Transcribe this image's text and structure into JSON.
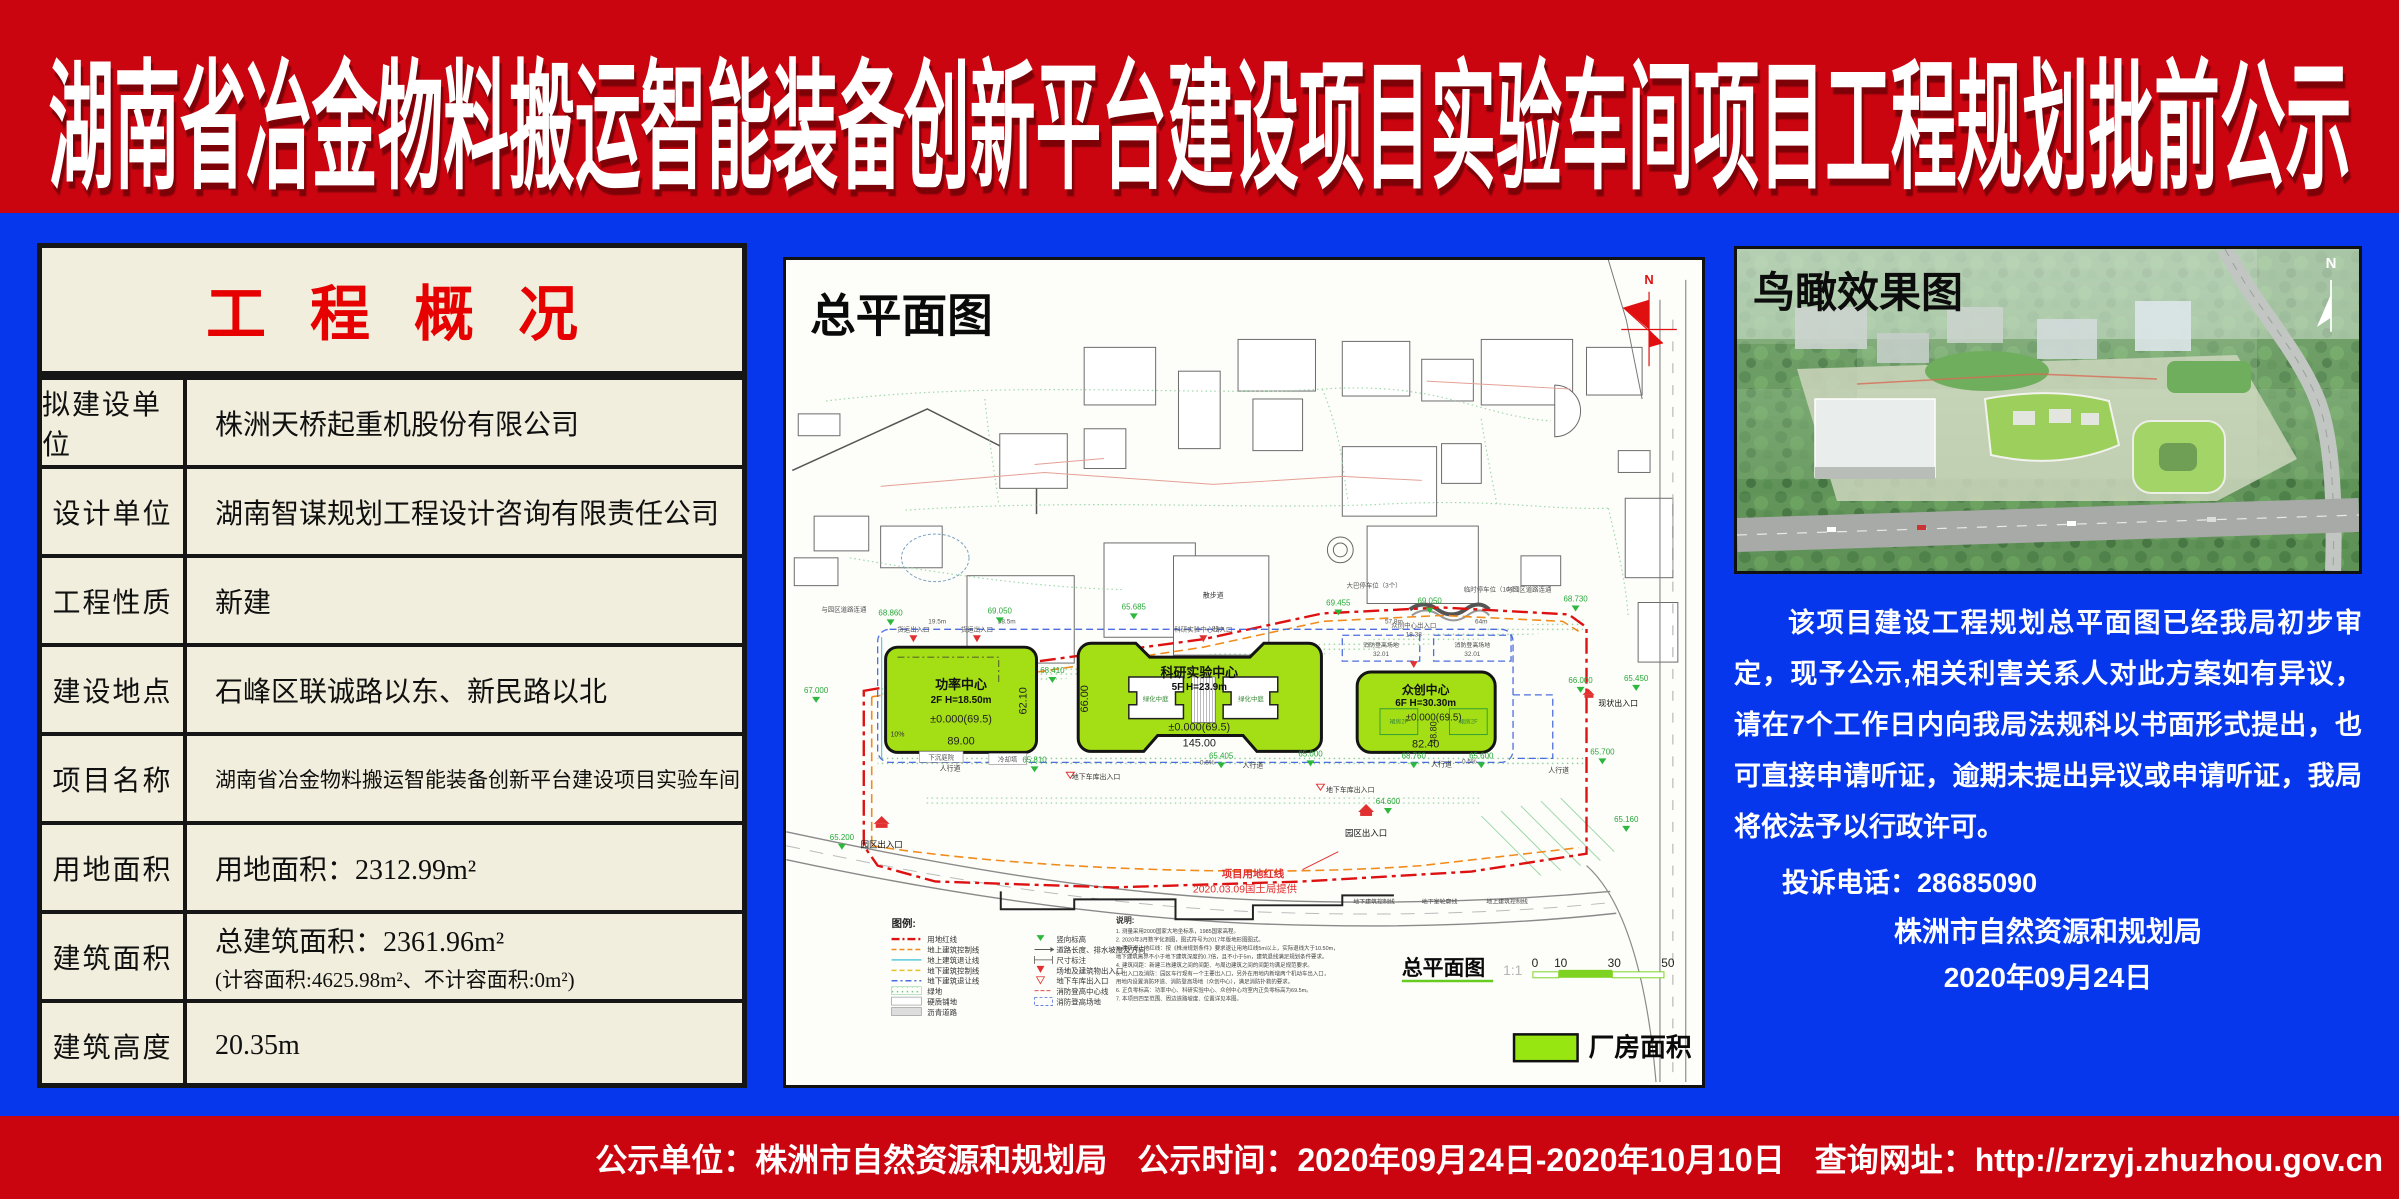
{
  "banner": {
    "title": "湖南省冶金物料搬运智能装备创新平台建设项目实验车间项目工程规划批前公示"
  },
  "overview_panel": {
    "title": "工程概况",
    "rows": [
      {
        "label": "拟建设单位",
        "value": "株洲天桥起重机股份有限公司"
      },
      {
        "label": "设计单位",
        "value": "湖南智谋规划工程设计咨询有限责任公司"
      },
      {
        "label": "工程性质",
        "value": "新建"
      },
      {
        "label": "建设地点",
        "value": "石峰区联诚路以东、新民路以北"
      },
      {
        "label": "项目名称",
        "value": "湖南省冶金物料搬运智能装备创新平台建设项目实验车间"
      },
      {
        "label": "用地面积",
        "value": "用地面积：2312.99m²"
      },
      {
        "label": "建筑面积",
        "value": "总建筑面积：2361.96m²",
        "value2": "(计容面积:4625.98m²、不计容面积:0m²)"
      },
      {
        "label": "建筑高度",
        "value": "20.35m"
      }
    ]
  },
  "site_plan": {
    "title": "总平面图",
    "north": "N",
    "buildings": [
      {
        "name": "功率中心",
        "spec": "2F H=18.50m",
        "elev": "±0.000(69.5)",
        "w": "89.00",
        "h": "62.10"
      },
      {
        "name": "科研实验中心",
        "spec": "5F H=23.9m",
        "elev": "±0.000(69.5)",
        "w": "145.00",
        "h": "66.00",
        "courtyard": "绿化中庭"
      },
      {
        "name": "众创中心",
        "spec": "6F H=30.30m",
        "elev": "±0.000(69.5)",
        "w": "82.40",
        "h": "48.80",
        "podium": "裙房2F"
      }
    ],
    "labels": {
      "walkway": "人行道",
      "stroll": "散步道",
      "connect": "与园区道路连通",
      "freight": "货运出入口",
      "srv_gate": "科研实验中心出入口",
      "maker_gate": "众创中心出入口",
      "maker_dim": "18.38",
      "fire_pad": "消防登高场地",
      "fire_dim": "32.01",
      "parking10": "临时停车位（10个）",
      "parking_bus": "大巴停车位（3个）",
      "cooling": "冷却塔",
      "sunken": "下沉庭院",
      "garage": "地下车库出入口",
      "park_gate": "园区出入口",
      "existing_gate": "现状出入口",
      "redline1": "项目用地红线",
      "redline2": "2020.03.09国土局提供",
      "u_ctrl": "地下建筑控制线",
      "u_profile": "地下室轮廓线",
      "a_ctrl": "地上建筑控制线",
      "slope1": "10%",
      "slope2": "0.6%",
      "slope3": "0.5%",
      "d1": "19.5m",
      "d2": "58.5m",
      "d3": "81m",
      "d4": "57.8m",
      "d5": "64m"
    },
    "elevations": [
      {
        "v": "67.000"
      },
      {
        "v": "68.860"
      },
      {
        "v": "69.050"
      },
      {
        "v": "65.685"
      },
      {
        "v": "69.455"
      },
      {
        "v": "69.050"
      },
      {
        "v": "68.730"
      },
      {
        "v": "66.000"
      },
      {
        "v": "65.450"
      },
      {
        "v": "68.410"
      },
      {
        "v": "65.810"
      },
      {
        "v": "65.405"
      },
      {
        "v": "65.000"
      },
      {
        "v": "68.760"
      },
      {
        "v": "65.600"
      },
      {
        "v": "65.700"
      },
      {
        "v": "64.600"
      },
      {
        "v": "65.160"
      },
      {
        "v": "65.200"
      }
    ],
    "legend": {
      "title": "图例:",
      "col1": [
        {
          "t": "用地红线"
        },
        {
          "t": "地上建筑控制线"
        },
        {
          "t": "地上建筑退让线"
        },
        {
          "t": "地下建筑控制线"
        },
        {
          "t": "地下建筑退让线"
        },
        {
          "t": "绿地"
        },
        {
          "t": "硬质铺地"
        },
        {
          "t": "沥青道路"
        }
      ],
      "col2": [
        {
          "t": "竖向标高"
        },
        {
          "t": "道路长度、排水坡度及方向"
        },
        {
          "t": "尺寸标注"
        },
        {
          "t": "场地及建筑物出入口"
        },
        {
          "t": "地下车库出入口"
        },
        {
          "t": "消防登高中心线"
        },
        {
          "t": "消防登高场地"
        }
      ]
    },
    "notes_title": "说明:",
    "notes": [
      "1. 测量采用2000国家大地坐标系，1985国家高程。",
      "2. 2020年3月数字化测图，图式符号为2017年版地形图图式。",
      "3. 建筑退让地红线：按《株洲规划条件》要求退让用地红线5m以上，实际退线大于10.50m，",
      "   地下建筑离界不小于地下建筑深度的0.7倍，且不小于5m，建筑退线满足规划条件要求。",
      "4. 建筑间距：新建三栋建筑之间的间距、与周边建筑之间的间距均满足规范要求。",
      "5. 出入口及消防：园区车行现有一个主要出入口，另外在用地内新增两个机动车出入口，",
      "   用地内设置消防环道、消防登高场地（众创中心），满足消防扑救的要求。",
      "6. 正负零标高：功率中心、科研实验中心、众创中心均室内正负零标高为69.5m。",
      "7. 本项目四至范围、周边道路坡度、位置详见本图。"
    ],
    "scale": {
      "name": "总平面图",
      "ratio": "1:1",
      "tick0": "0",
      "tick1": "10",
      "tick2": "30",
      "tick3": "50"
    },
    "area_legend": "厂房面积"
  },
  "aerial_panel": {
    "title": "鸟瞰效果图",
    "north": "N",
    "notice": "该项目建设工程规划总平面图已经我局初步审定，现予公示,相关利害关系人对此方案如有异议，请在7个工作日内向我局法规科以书面形式提出，也可直接申请听证，逾期未提出异议或申请听证，我局将依法予以行政许可。",
    "phone": "投诉电话：28685090",
    "org": "株洲市自然资源和规划局",
    "date": "2020年09月24日"
  },
  "footer": {
    "unit": "公示单位：株洲市自然资源和规划局",
    "time": "公示时间：2020年09月24日-2020年10月10日",
    "url": "查询网址：http://zrzyj.zhuzhou.gov.cn"
  }
}
